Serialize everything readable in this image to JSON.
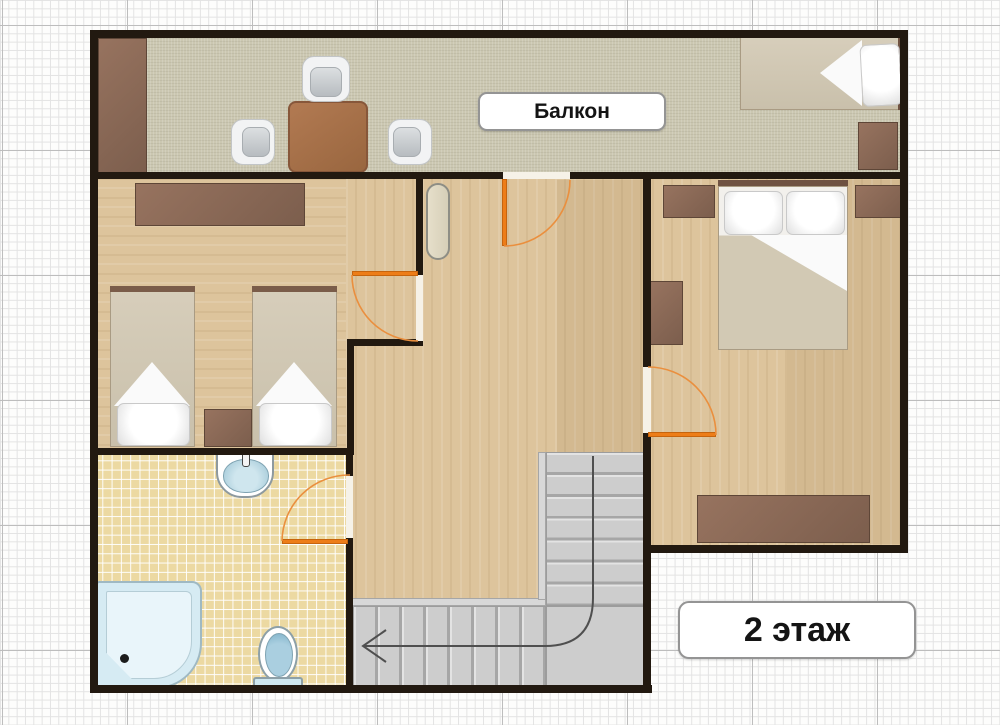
{
  "labels": {
    "balcony": "Балкон",
    "floor_badge": "2 этаж"
  },
  "colors": {
    "accent_orange": "#ed7d18",
    "wall": "#221910",
    "wood_floor": "#ddc49c",
    "balcony_floor": "#cbc7b1",
    "tile_floor": "#ecd9a2",
    "fixture_blue": "#cfe6ee",
    "furniture_brown": "#876855",
    "table_brown": "#a7734e",
    "stair_gray": "#cdcdcd",
    "mattress_tan": "#d2c9b6"
  },
  "icons": {
    "wardrobe": "css-rect",
    "dining-table": "css-rect",
    "chair": "css-shape",
    "single-bed": "css-shape",
    "double-bed": "css-shape",
    "nightstand": "css-rect",
    "shelf": "css-rect",
    "dresser": "css-rect",
    "sideboard": "css-rect",
    "radiator": "css-capsule",
    "sink": "css-shape",
    "toilet": "css-shape",
    "corner-shower": "css-shape",
    "staircase": "css-gradient-steps",
    "door-swing": "svg-arc"
  }
}
